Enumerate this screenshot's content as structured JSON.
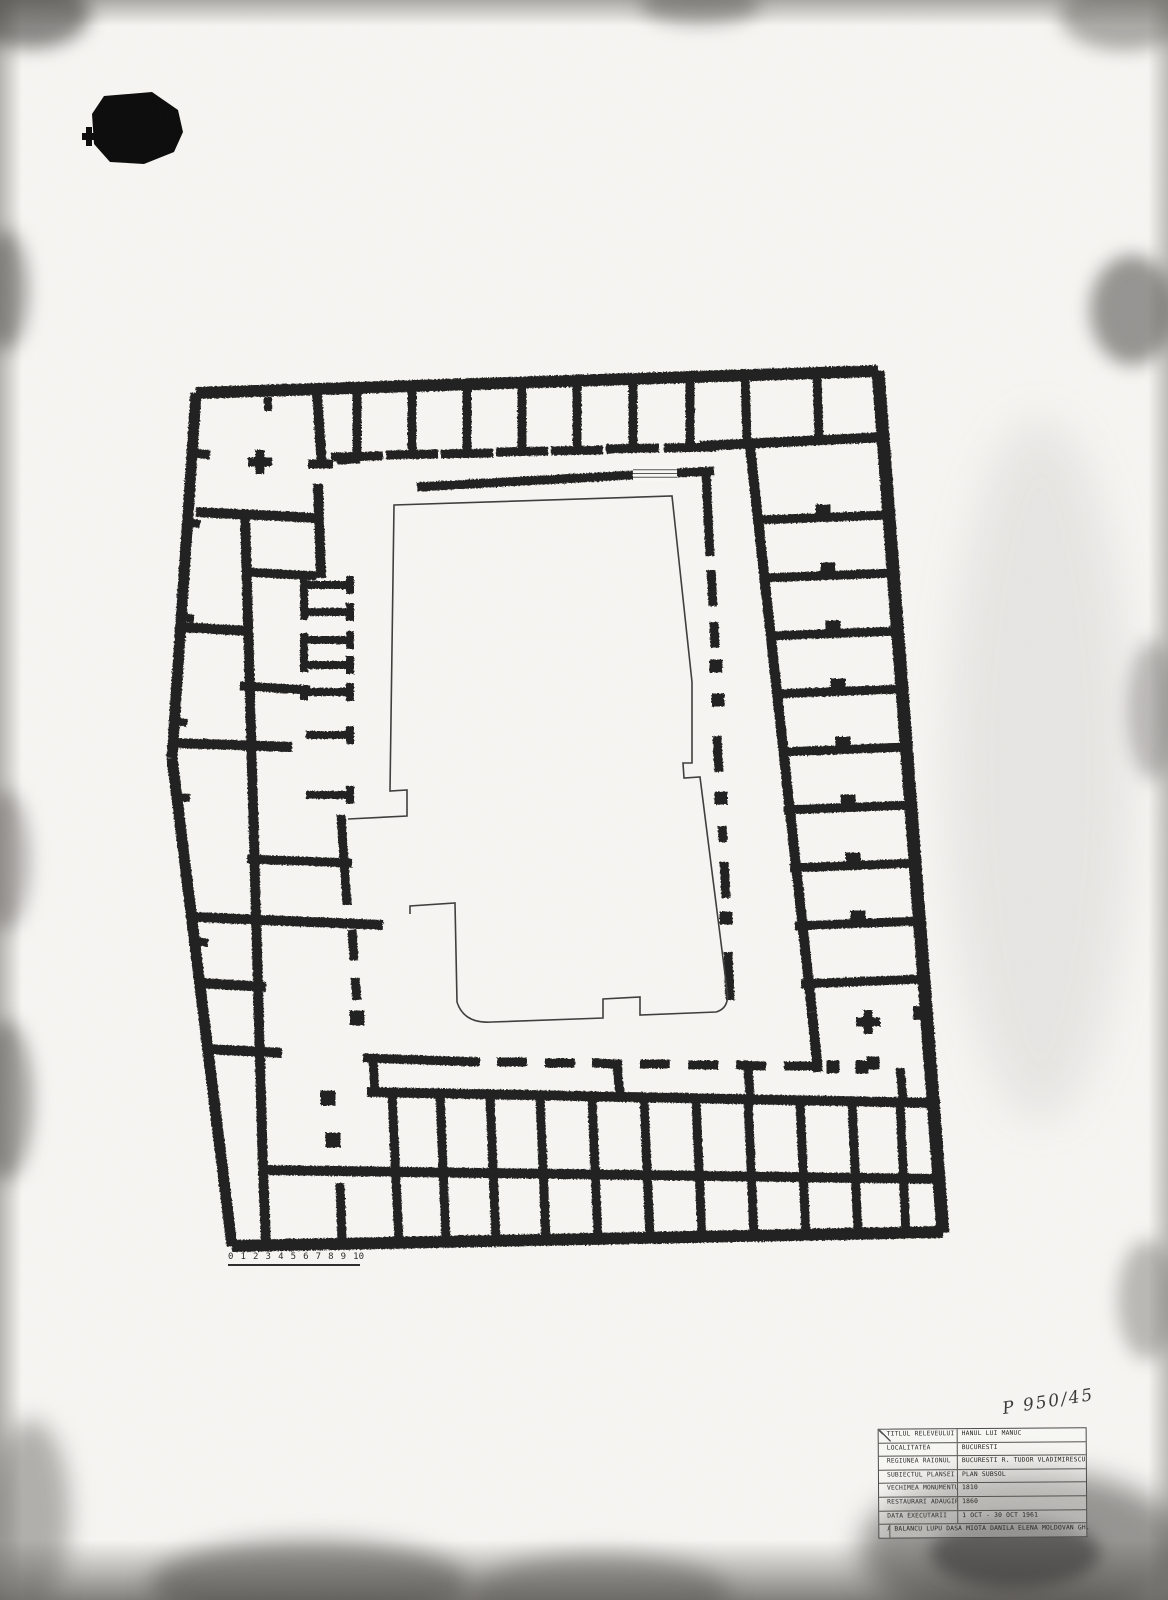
{
  "document": {
    "kind": "scanned architectural survey drawing",
    "subject": "Hanul lui Manuc - basement plan"
  },
  "archive_number": {
    "text": "P 950/45"
  },
  "scale_bar": {
    "ticks": [
      "0",
      "1",
      "2",
      "3",
      "4",
      "5",
      "6",
      "7",
      "8",
      "9",
      "10"
    ]
  },
  "title_block": {
    "rows": [
      {
        "label": "TITLUL RELEVEULUI",
        "value": "HANUL LUI MANUC"
      },
      {
        "label": "LOCALITATEA",
        "value": "BUCURESTI"
      },
      {
        "label": "REGIUNEA RAIONUL",
        "value": "BUCURESTI   R. TUDOR VLADIMIRESCU"
      },
      {
        "label": "SUBIECTUL PLANSEI",
        "value": "PLAN SUBSOL"
      },
      {
        "label": "VECHIMEA MONUMENTULUI",
        "value": "1810"
      },
      {
        "label": "RESTAURARI ADAUGIRI",
        "value": "1860"
      },
      {
        "label": "DATA EXECUTARII",
        "value": "1 OCT - 30 OCT 1961"
      },
      {
        "label": "AUTORII RELEVEULUI",
        "value": "BALANCU LUPU  DASA MIOTA  DANILA ELENA  MOLDOVAN GH."
      }
    ]
  },
  "plan": {
    "ink_color": "#222120",
    "courtyard_line_color": "#3f3f3d",
    "wall_segments": [
      [
        196,
        393,
        878,
        371,
        12
      ],
      [
        878,
        371,
        943,
        1233,
        13
      ],
      [
        232,
        1246,
        943,
        1232,
        12
      ],
      [
        196,
        393,
        172,
        758,
        11
      ],
      [
        172,
        758,
        232,
        1246,
        11
      ],
      [
        268,
        397,
        268,
        411,
        8
      ],
      [
        357,
        388,
        357,
        452,
        9
      ],
      [
        412,
        386,
        412,
        451,
        9
      ],
      [
        467,
        384,
        467,
        450,
        9
      ],
      [
        522,
        382,
        522,
        449,
        9
      ],
      [
        577,
        381,
        577,
        447,
        9
      ],
      [
        633,
        379,
        633,
        446,
        9
      ],
      [
        690,
        377,
        690,
        444,
        9
      ],
      [
        337,
        460,
        360,
        459,
        9
      ],
      [
        331,
        457,
        383,
        456,
        9
      ],
      [
        386,
        455,
        438,
        454,
        9
      ],
      [
        441,
        454,
        493,
        453,
        9
      ],
      [
        496,
        452,
        548,
        451,
        9
      ],
      [
        551,
        451,
        603,
        450,
        9
      ],
      [
        606,
        449,
        659,
        448,
        9
      ],
      [
        664,
        448,
        716,
        447,
        9
      ],
      [
        745,
        375,
        747,
        440,
        9
      ],
      [
        817,
        373,
        819,
        438,
        9
      ],
      [
        700,
        446,
        885,
        437,
        10
      ],
      [
        417,
        487,
        633,
        475,
        9
      ],
      [
        677,
        473,
        714,
        471,
        9
      ],
      [
        750,
        446,
        812,
        1012,
        10
      ],
      [
        757,
        520,
        889,
        515,
        9
      ],
      [
        762,
        578,
        894,
        573,
        9
      ],
      [
        768,
        636,
        898,
        631,
        9
      ],
      [
        773,
        694,
        902,
        689,
        9
      ],
      [
        779,
        752,
        907,
        747,
        9
      ],
      [
        784,
        810,
        911,
        805,
        9
      ],
      [
        790,
        868,
        915,
        863,
        9
      ],
      [
        795,
        926,
        920,
        921,
        9
      ],
      [
        801,
        984,
        924,
        979,
        9
      ],
      [
        812,
        1012,
        818,
        1072,
        10
      ],
      [
        706,
        474,
        710,
        556,
        9
      ],
      [
        711,
        570,
        713,
        606,
        9
      ],
      [
        714,
        622,
        715,
        648,
        9
      ],
      [
        717,
        736,
        719,
        772,
        9
      ],
      [
        722,
        826,
        723,
        842,
        9
      ],
      [
        724,
        862,
        726,
        898,
        9
      ],
      [
        728,
        952,
        730,
        1000,
        9
      ],
      [
        363,
        1058,
        480,
        1062,
        9
      ],
      [
        497,
        1062,
        527,
        1062,
        9
      ],
      [
        545,
        1063,
        575,
        1063,
        9
      ],
      [
        592,
        1063,
        622,
        1064,
        9
      ],
      [
        640,
        1064,
        670,
        1064,
        9
      ],
      [
        688,
        1065,
        718,
        1065,
        9
      ],
      [
        736,
        1065,
        766,
        1066,
        9
      ],
      [
        784,
        1066,
        814,
        1066,
        9
      ],
      [
        367,
        1092,
        940,
        1103,
        10
      ],
      [
        260,
        1170,
        940,
        1179,
        10
      ],
      [
        392,
        1094,
        399,
        1242,
        9
      ],
      [
        440,
        1095,
        446,
        1241,
        9
      ],
      [
        490,
        1096,
        496,
        1241,
        9
      ],
      [
        540,
        1097,
        546,
        1240,
        9
      ],
      [
        592,
        1098,
        598,
        1239,
        9
      ],
      [
        644,
        1099,
        650,
        1238,
        9
      ],
      [
        696,
        1100,
        702,
        1238,
        9
      ],
      [
        748,
        1100,
        754,
        1237,
        9
      ],
      [
        800,
        1101,
        806,
        1236,
        9
      ],
      [
        852,
        1102,
        858,
        1235,
        9
      ],
      [
        900,
        1102,
        906,
        1235,
        9
      ],
      [
        373,
        1060,
        375,
        1092,
        9
      ],
      [
        617,
        1066,
        620,
        1095,
        9
      ],
      [
        748,
        1066,
        750,
        1096,
        9
      ],
      [
        900,
        1068,
        903,
        1100,
        9
      ],
      [
        340,
        1183,
        342,
        1240,
        9
      ],
      [
        245,
        514,
        263,
        1170,
        10
      ],
      [
        263,
        1170,
        266,
        1243,
        10
      ],
      [
        317,
        394,
        322,
        468,
        10
      ],
      [
        308,
        464,
        333,
        464,
        9
      ],
      [
        318,
        484,
        321,
        578,
        10
      ],
      [
        196,
        512,
        318,
        518,
        10
      ],
      [
        246,
        572,
        316,
        576,
        9
      ],
      [
        181,
        627,
        248,
        631,
        10
      ],
      [
        240,
        686,
        310,
        690,
        9
      ],
      [
        173,
        743,
        292,
        747,
        10
      ],
      [
        177,
        797,
        190,
        798,
        8
      ],
      [
        247,
        859,
        352,
        863,
        9
      ],
      [
        192,
        917,
        383,
        925,
        10
      ],
      [
        200,
        983,
        266,
        987,
        10
      ],
      [
        206,
        1049,
        282,
        1053,
        10
      ],
      [
        196,
        453,
        210,
        455,
        9
      ],
      [
        306,
        585,
        350,
        585,
        8
      ],
      [
        350,
        576,
        350,
        594,
        8
      ],
      [
        306,
        612,
        350,
        612,
        8
      ],
      [
        350,
        603,
        350,
        621,
        8
      ],
      [
        306,
        640,
        350,
        640,
        8
      ],
      [
        350,
        631,
        350,
        649,
        8
      ],
      [
        306,
        665,
        350,
        665,
        8
      ],
      [
        350,
        656,
        350,
        674,
        8
      ],
      [
        306,
        692,
        350,
        692,
        8
      ],
      [
        350,
        683,
        350,
        701,
        8
      ],
      [
        306,
        735,
        350,
        735,
        8
      ],
      [
        350,
        726,
        350,
        744,
        8
      ],
      [
        306,
        795,
        350,
        795,
        8
      ],
      [
        350,
        786,
        350,
        804,
        8
      ],
      [
        304,
        578,
        304,
        620,
        8
      ],
      [
        304,
        633,
        304,
        672,
        8
      ],
      [
        304,
        685,
        304,
        700,
        8
      ],
      [
        341,
        815,
        347,
        905,
        9
      ],
      [
        352,
        930,
        354,
        960,
        9
      ],
      [
        355,
        978,
        357,
        1000,
        9
      ],
      [
        188,
        522,
        200,
        524,
        8
      ],
      [
        182,
        617,
        194,
        619,
        8
      ],
      [
        175,
        721,
        187,
        723,
        8
      ],
      [
        196,
        941,
        208,
        943,
        8
      ]
    ],
    "piers": [
      [
        823,
        512,
        15
      ],
      [
        828,
        570,
        15
      ],
      [
        833,
        628,
        15
      ],
      [
        838,
        686,
        15
      ],
      [
        843,
        744,
        15
      ],
      [
        848,
        802,
        15
      ],
      [
        853,
        860,
        15
      ],
      [
        858,
        918,
        15
      ],
      [
        716,
        666,
        13
      ],
      [
        718,
        700,
        13
      ],
      [
        721,
        798,
        13
      ],
      [
        726,
        918,
        13
      ],
      [
        833,
        1067,
        13
      ],
      [
        862,
        1067,
        13
      ],
      [
        920,
        1013,
        14
      ],
      [
        873,
        1063,
        13
      ],
      [
        357,
        1018,
        15
      ],
      [
        328,
        1098,
        15
      ],
      [
        333,
        1140,
        15
      ]
    ],
    "cross_piers": [
      [
        260,
        462
      ],
      [
        868,
        1022
      ]
    ],
    "courtyard_path": "M 348 819 L 407 816 L 407 790 L 390 791 L 394 505 L 672 496 L 692 682 L 692 763 L 683 763 L 684 778 L 700 777 L 727 990 Q 730 1008 716 1012 L 640 1015 L 640 997 L 603 999 L 603 1018 L 492 1022 Q 464 1024 457 1002 L 455 903 L 410 906 L 410 914",
    "stair_patch": {
      "x": 633,
      "y": 466,
      "w": 44,
      "h": 15,
      "lines": 3
    }
  }
}
